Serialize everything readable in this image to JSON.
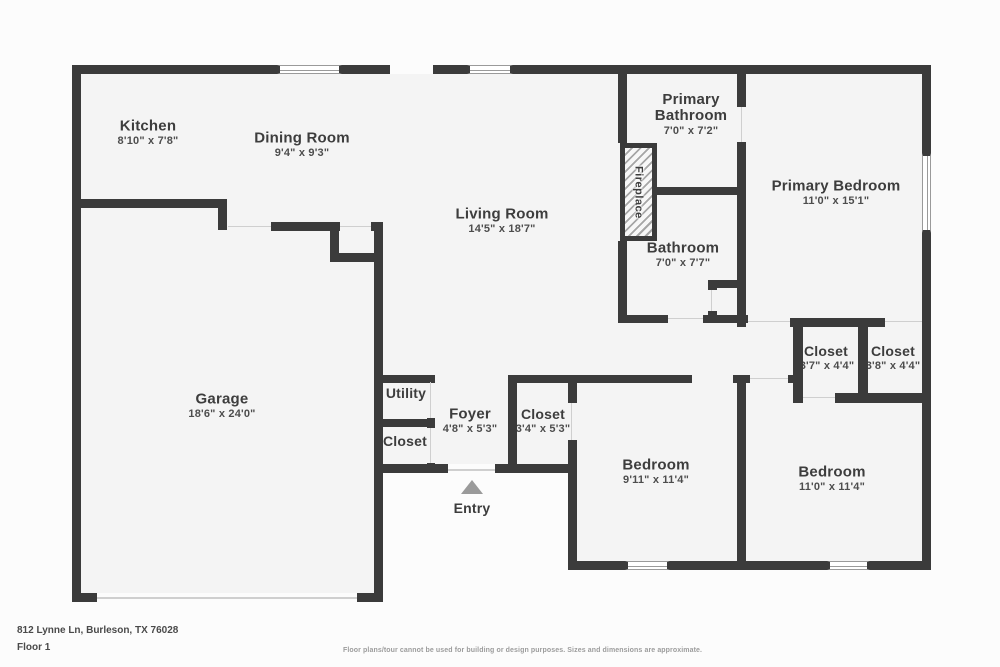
{
  "floorplan": {
    "rooms": [
      {
        "name": "Kitchen",
        "dims": "8'10\" x 7'8\""
      },
      {
        "name": "Dining Room",
        "dims": "9'4\" x 9'3\""
      },
      {
        "name": "Living Room",
        "dims": "14'5\" x 18'7\""
      },
      {
        "name": "Primary Bathroom",
        "dims": "7'0\" x 7'2\""
      },
      {
        "name": "Primary Bedroom",
        "dims": "11'0\" x 15'1\""
      },
      {
        "name": "Bathroom",
        "dims": "7'0\" x 7'7\""
      },
      {
        "name": "Closet",
        "dims": "3'7\" x 4'4\""
      },
      {
        "name": "Closet",
        "dims": "3'8\" x 4'4\""
      },
      {
        "name": "Garage",
        "dims": "18'6\" x 24'0\""
      },
      {
        "name": "Utility",
        "dims": ""
      },
      {
        "name": "Closet",
        "dims": ""
      },
      {
        "name": "Foyer",
        "dims": "4'8\" x 5'3\""
      },
      {
        "name": "Closet",
        "dims": "3'4\" x 5'3\""
      },
      {
        "name": "Bedroom",
        "dims": "9'11\" x 11'4\""
      },
      {
        "name": "Bedroom",
        "dims": "11'0\" x 11'4\""
      }
    ],
    "features": {
      "fireplace": "Fireplace",
      "entry": "Entry"
    },
    "colors": {
      "wall": "#3b3b3b",
      "room_fill": "#f4f4f4",
      "marker_gray": "#9a9a9a"
    },
    "footer": {
      "address": "812 Lynne Ln, Burleson, TX 76028",
      "floor": "Floor 1",
      "disclaimer": "Floor plans/tour cannot be used for building or design purposes. Sizes and dimensions are approximate."
    }
  }
}
